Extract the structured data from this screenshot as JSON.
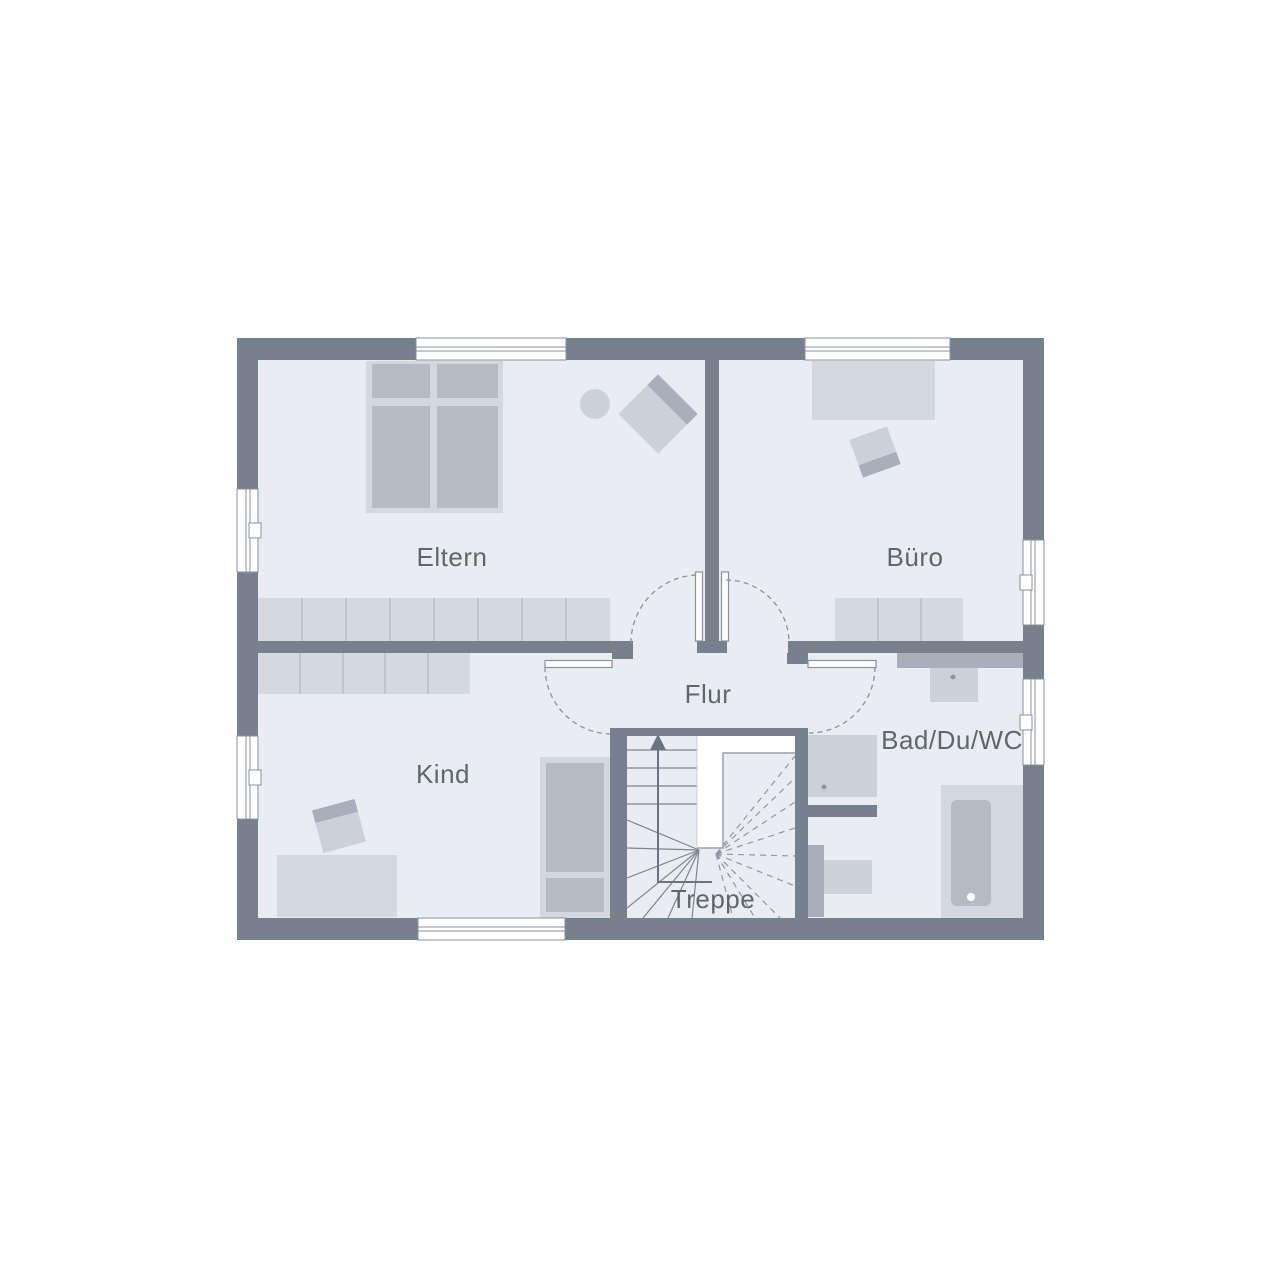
{
  "plan": {
    "type": "floor-plan",
    "floor_description": "upper floor with stairwell",
    "stairs_arrow_direction": "up"
  },
  "rooms": [
    {
      "id": "eltern",
      "label": "Eltern"
    },
    {
      "id": "buero",
      "label": "Büro"
    },
    {
      "id": "flur",
      "label": "Flur"
    },
    {
      "id": "kind",
      "label": "Kind"
    },
    {
      "id": "bad",
      "label": "Bad/Du/WC"
    },
    {
      "id": "treppe",
      "label": "Treppe"
    }
  ],
  "colors": {
    "background": "#ffffff",
    "wall": "#77818e",
    "floor": "#e9ecf0",
    "furniture_light": "#d3d8de",
    "furniture_medium": "#b5bbc5",
    "furniture_chair": "#ccd1d9",
    "furniture_dark": "#a9afba",
    "window_fill": "#ffffff",
    "outline": "#8a919d",
    "stair_line": "#7d8692",
    "label_text": "#5f6670"
  }
}
